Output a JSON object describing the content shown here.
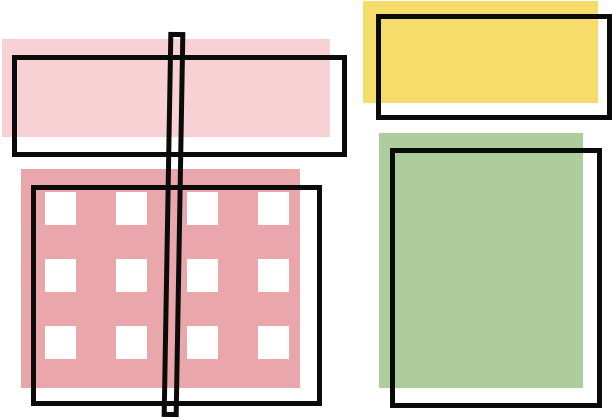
{
  "scene": {
    "description": "Abstract flat-design illustration: overlapping pastel rectangles (light pink, rose with white square grid, yellow, green) with offset black outline frames and a tall thin hollow black bar crossing the left side",
    "canvas_width": 612,
    "canvas_height": 420
  },
  "colors": {
    "canvas": "#ffffff",
    "ink": "#0b0b0b",
    "light_pink": "#f8d1d5",
    "rose": "#e9a6ab",
    "yellow": "#f6dc6a",
    "green": "#adcd9d",
    "square_fill": "#ffffff"
  },
  "shapes": {
    "light_pink_rect": {
      "fill": "#f8d1d5"
    },
    "rose_rect": {
      "fill": "#e9a6ab"
    },
    "yellow_rect": {
      "fill": "#f6dc6a"
    },
    "green_rect": {
      "fill": "#adcd9d"
    },
    "outline_frame_count": 4,
    "vertical_bar": {
      "stroke": "#0b0b0b",
      "hollow": true
    }
  },
  "grid": {
    "rows": 3,
    "cols": 4,
    "square_fill": "#ffffff"
  }
}
